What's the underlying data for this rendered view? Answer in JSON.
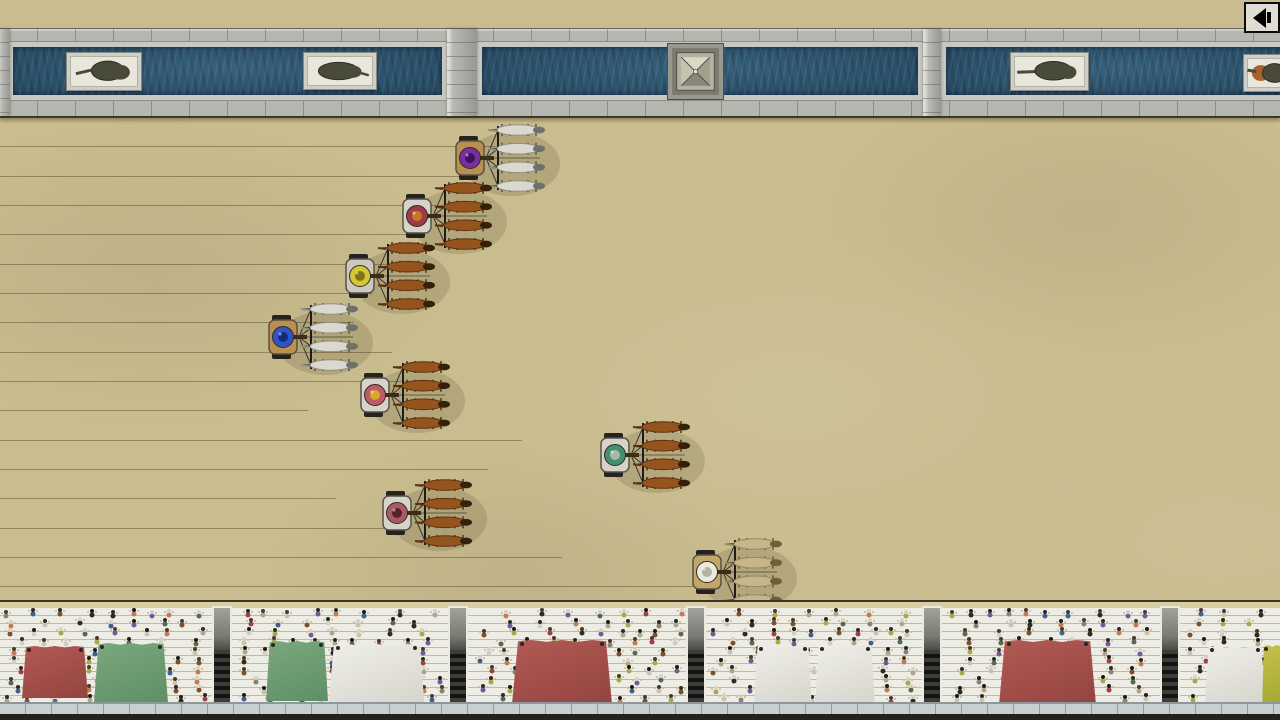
{
  "scene": {
    "name": "top-down chariot race - circus spina, track and grandstand",
    "width": 1280,
    "height": 720
  },
  "audio_button": {
    "icon": "speaker-left-icon",
    "x": 1244,
    "y": 2,
    "w": 36,
    "h": 31
  },
  "palette": {
    "sand": "#c9bc8e",
    "stone": "#b6b5af",
    "water": "#2c5876",
    "awning_red": "#a4504c",
    "awning_green": "#72a077",
    "awning_white": "#e6e5de",
    "awning_yellow": "#b6b63e",
    "crowd_arms": "#c9b894"
  },
  "spina": {
    "pools": [
      {
        "x": 8,
        "w": 429
      },
      {
        "x": 477,
        "w": 436
      },
      {
        "x": 941,
        "w": 345
      }
    ],
    "pillars": [
      {
        "x": -4,
        "w": 14
      },
      {
        "x": 447,
        "w": 30
      },
      {
        "x": 923,
        "w": 18
      }
    ],
    "monuments": [
      {
        "kind": "statue",
        "cx": 104,
        "cy": 70,
        "w": 74,
        "h": 37,
        "variant": 1
      },
      {
        "kind": "statue",
        "cx": 340,
        "cy": 70,
        "w": 72,
        "h": 36,
        "variant": 2
      },
      {
        "kind": "obelisk",
        "cx": 695,
        "cy": 70,
        "size": 57
      },
      {
        "kind": "statue",
        "cx": 1049,
        "cy": 70,
        "w": 77,
        "h": 37,
        "variant": 3
      },
      {
        "kind": "statue",
        "cx": 1272,
        "cy": 72,
        "w": 56,
        "h": 36,
        "variant": 4,
        "accent": "#a8622c"
      }
    ]
  },
  "track": {
    "lane_line_color": "rgba(92,76,44,0.5)",
    "lane_lines": [
      {
        "y": 146,
        "len": 505
      },
      {
        "y": 176,
        "len": 472
      },
      {
        "y": 205,
        "len": 460
      },
      {
        "y": 234,
        "len": 424
      },
      {
        "y": 264,
        "len": 416
      },
      {
        "y": 293,
        "len": 372
      },
      {
        "y": 322,
        "len": 354
      },
      {
        "y": 352,
        "len": 392
      },
      {
        "y": 381,
        "len": 436
      },
      {
        "y": 410,
        "len": 308
      },
      {
        "y": 440,
        "len": 522
      },
      {
        "y": 469,
        "len": 488
      },
      {
        "y": 498,
        "len": 336
      },
      {
        "y": 528,
        "len": 384
      },
      {
        "y": 557,
        "len": 562
      },
      {
        "y": 586,
        "len": 705
      }
    ]
  },
  "chariots": [
    {
      "team": "purple",
      "x": 470,
      "y": 158,
      "cart": "#bb8f4e",
      "ring": "#7a2f9e",
      "center": "#3f1060",
      "horse": "#dad9d0",
      "horse_edge": "#8f8f86",
      "head": "#70706a",
      "leg": "#4a463c"
    },
    {
      "team": "crimson",
      "x": 417,
      "y": 216,
      "cart": "#d6d3c9",
      "ring": "#a03a48",
      "center": "#c77a22",
      "horse": "#95541e",
      "horse_edge": "#5e3310",
      "head": "#35200a",
      "leg": "#2f2213"
    },
    {
      "team": "yellow",
      "x": 360,
      "y": 276,
      "cart": "#cccac0",
      "ring": "#d4c634",
      "center": "#7f7410",
      "horse": "#95541e",
      "horse_edge": "#5e3310",
      "head": "#35200a",
      "leg": "#2f2213"
    },
    {
      "team": "blue",
      "x": 283,
      "y": 337,
      "cart": "#bb8f4e",
      "ring": "#2f54c8",
      "center": "#122c7e",
      "horse": "#dad9d0",
      "horse_edge": "#8f8f86",
      "head": "#70706a",
      "leg": "#4a463c"
    },
    {
      "team": "red",
      "x": 375,
      "y": 395,
      "cart": "#d6d3c9",
      "ring": "#c05a64",
      "center": "#d9a62e",
      "horse": "#95541e",
      "horse_edge": "#5e3310",
      "head": "#35200a",
      "leg": "#2f2213"
    },
    {
      "team": "teal",
      "x": 615,
      "y": 455,
      "cart": "#d6d3c9",
      "ring": "#44906a",
      "center": "#a9b8ae",
      "horse": "#95541e",
      "horse_edge": "#5e3310",
      "head": "#35200a",
      "leg": "#2f2213"
    },
    {
      "team": "maroon",
      "x": 397,
      "y": 513,
      "cart": "#d6d3c9",
      "ring": "#aa5a64",
      "center": "#57222e",
      "horse": "#95541e",
      "horse_edge": "#5e3310",
      "head": "#35200a",
      "leg": "#2f2213"
    },
    {
      "team": "white",
      "x": 707,
      "y": 572,
      "cart": "#c2a768",
      "ring": "#eceadf",
      "center": "#b5b1a2",
      "horse": "#c6b689",
      "horse_edge": "#97875e",
      "head": "#6e5e3a",
      "leg": "#57492c"
    }
  ],
  "stands": {
    "stairs_x": [
      222,
      458,
      696,
      932,
      1170
    ],
    "awnings": [
      {
        "x": 22,
        "w": 66,
        "top": 46,
        "h": 52,
        "color": "red"
      },
      {
        "x": 94,
        "w": 74,
        "top": 43,
        "h": 60,
        "color": "green"
      },
      {
        "x": 266,
        "w": 62,
        "top": 41,
        "h": 60,
        "color": "green"
      },
      {
        "x": 328,
        "w": 97,
        "top": 44,
        "h": 64,
        "color": "white"
      },
      {
        "x": 512,
        "w": 100,
        "top": 40,
        "h": 64,
        "color": "red"
      },
      {
        "x": 754,
        "w": 58,
        "top": 45,
        "h": 63,
        "color": "white"
      },
      {
        "x": 815,
        "w": 60,
        "top": 45,
        "h": 63,
        "color": "white"
      },
      {
        "x": 999,
        "w": 97,
        "top": 40,
        "h": 65,
        "color": "red"
      },
      {
        "x": 1205,
        "w": 60,
        "top": 46,
        "h": 62,
        "color": "white"
      },
      {
        "x": 1262,
        "w": 30,
        "top": 45,
        "h": 65,
        "color": "yellow"
      }
    ],
    "crowd": {
      "rows": 10,
      "row_h": 9.5,
      "seed": 7,
      "body_colors": [
        "#8a8171",
        "#b0a48a",
        "#9c4242",
        "#6f5a9c",
        "#3f5f92",
        "#c9c2ac",
        "#2d2a22",
        "#a8a848",
        "#7a4f2a",
        "#cfcfc8",
        "#c27b4f",
        "#556b4f"
      ],
      "head_colors": [
        "#1e1a14",
        "#2e2a22",
        "#d8d0c0",
        "#4a3a2a"
      ],
      "arm_color": "#c9b894"
    }
  }
}
